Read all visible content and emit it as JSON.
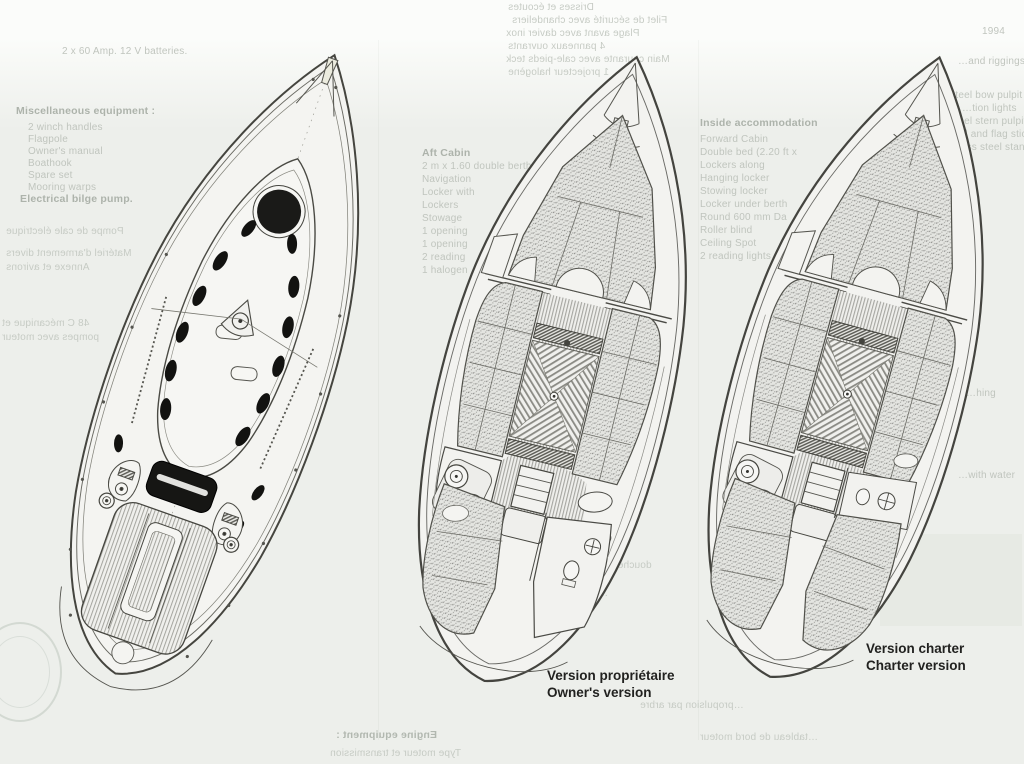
{
  "page": {
    "description": "Scanned sailboat brochure page with deck plan and two interior layout drawings",
    "colors": {
      "paper": "#edefeb",
      "ink": "#45453f",
      "caption_ink": "#222220",
      "ghost_text": "#c0c5be"
    }
  },
  "captions": {
    "owner": {
      "line1": "Version propriétaire",
      "line2": "Owner's version"
    },
    "charter": {
      "line1": "Version charter",
      "line2": "Charter version"
    }
  },
  "drawings": [
    {
      "id": "deck-plan",
      "description": "Deck plan seen from above: foredeck hatch, coachroof with portlights, mast, sprayhood, slatted cockpit benches"
    },
    {
      "id": "owner-layout",
      "description": "Interior plan, owner's version: V-berth, saloon with folding table, galley, nav/head, single aft cabin"
    },
    {
      "id": "charter-layout",
      "description": "Interior plan, charter version: V-berth, saloon with folding table, galley, head, twin aft cabins"
    }
  ],
  "ghost_text": {
    "note": "faint show-through / overexposed spec text from the printed page",
    "items": [
      {
        "x": 62,
        "y": 46,
        "t": "2 x 60 Amp. 12 V batteries.",
        "cls": ""
      },
      {
        "x": 16,
        "y": 106,
        "t": "Miscellaneous equipment :",
        "cls": "s"
      },
      {
        "x": 28,
        "y": 122,
        "t": "2 winch handles",
        "cls": ""
      },
      {
        "x": 28,
        "y": 134,
        "t": "Flagpole",
        "cls": ""
      },
      {
        "x": 28,
        "y": 146,
        "t": "Owner's manual",
        "cls": ""
      },
      {
        "x": 28,
        "y": 158,
        "t": "Boathook",
        "cls": ""
      },
      {
        "x": 28,
        "y": 170,
        "t": "Spare set",
        "cls": ""
      },
      {
        "x": 28,
        "y": 182,
        "t": "Mooring warps",
        "cls": ""
      },
      {
        "x": 20,
        "y": 194,
        "t": "Electrical bilge pump.",
        "cls": "s"
      },
      {
        "x": 6,
        "y": 226,
        "t": "Pompe de cale électrique",
        "cls": "m"
      },
      {
        "x": 6,
        "y": 248,
        "t": "Matériel d'armement divers",
        "cls": "m"
      },
      {
        "x": 6,
        "y": 262,
        "t": "Annexe et avirons",
        "cls": "m"
      },
      {
        "x": 2,
        "y": 318,
        "t": "48 C mécanique et",
        "cls": "m"
      },
      {
        "x": 2,
        "y": 332,
        "t": "pompes avec moteur",
        "cls": "m"
      },
      {
        "x": 508,
        "y": 2,
        "t": "Drisses et écoutes",
        "cls": "m"
      },
      {
        "x": 512,
        "y": 15,
        "t": "Filet de sécurité avec chandeliers",
        "cls": "m"
      },
      {
        "x": 506,
        "y": 28,
        "t": "Plage avant avec davier inox",
        "cls": "m"
      },
      {
        "x": 508,
        "y": 41,
        "t": "4 panneaux ouvrants",
        "cls": "m"
      },
      {
        "x": 506,
        "y": 54,
        "t": "Main courante avec cale-pieds teck",
        "cls": "m"
      },
      {
        "x": 508,
        "y": 67,
        "t": "1 projecteur halogène",
        "cls": "m"
      },
      {
        "x": 422,
        "y": 148,
        "t": "Aft Cabin",
        "cls": "s"
      },
      {
        "x": 422,
        "y": 161,
        "t": "2 m x 1.60 double berth",
        "cls": ""
      },
      {
        "x": 422,
        "y": 174,
        "t": "Navigation",
        "cls": ""
      },
      {
        "x": 422,
        "y": 187,
        "t": "Locker with",
        "cls": ""
      },
      {
        "x": 422,
        "y": 200,
        "t": "Lockers",
        "cls": ""
      },
      {
        "x": 422,
        "y": 213,
        "t": "Stowage",
        "cls": ""
      },
      {
        "x": 422,
        "y": 226,
        "t": "1 opening",
        "cls": ""
      },
      {
        "x": 422,
        "y": 239,
        "t": "1 opening",
        "cls": ""
      },
      {
        "x": 422,
        "y": 252,
        "t": "2 reading",
        "cls": ""
      },
      {
        "x": 422,
        "y": 265,
        "t": "1 halogen",
        "cls": ""
      },
      {
        "x": 700,
        "y": 118,
        "t": "Inside accommodation",
        "cls": "s"
      },
      {
        "x": 700,
        "y": 134,
        "t": "Forward Cabin",
        "cls": ""
      },
      {
        "x": 700,
        "y": 147,
        "t": "Double bed (2.20 ft x",
        "cls": ""
      },
      {
        "x": 700,
        "y": 160,
        "t": "Lockers along",
        "cls": ""
      },
      {
        "x": 700,
        "y": 173,
        "t": "Hanging locker",
        "cls": ""
      },
      {
        "x": 700,
        "y": 186,
        "t": "Stowing locker",
        "cls": ""
      },
      {
        "x": 700,
        "y": 199,
        "t": "Locker under berth",
        "cls": ""
      },
      {
        "x": 700,
        "y": 212,
        "t": "Round 600 mm Da",
        "cls": ""
      },
      {
        "x": 700,
        "y": 225,
        "t": "Roller blind",
        "cls": ""
      },
      {
        "x": 700,
        "y": 238,
        "t": "Ceiling Spot",
        "cls": ""
      },
      {
        "x": 700,
        "y": 251,
        "t": "2 reading lights",
        "cls": ""
      },
      {
        "x": 982,
        "y": 26,
        "t": "1994",
        "cls": ""
      },
      {
        "x": 958,
        "y": 56,
        "t": "…and riggings",
        "cls": ""
      },
      {
        "x": 940,
        "y": 90,
        "t": "…steel bow pulpit with integr",
        "cls": ""
      },
      {
        "x": 962,
        "y": 103,
        "t": "…tion lights",
        "cls": ""
      },
      {
        "x": 940,
        "y": 116,
        "t": "…steel stern pulpit with",
        "cls": ""
      },
      {
        "x": 946,
        "y": 129,
        "t": "…ed and flag stick",
        "cls": ""
      },
      {
        "x": 940,
        "y": 142,
        "t": "…inless steel stanchions",
        "cls": ""
      },
      {
        "x": 470,
        "y": 490,
        "t": "1 penderie, équipets et coffres",
        "cls": "m"
      },
      {
        "x": 468,
        "y": 520,
        "t": "2 équipiers",
        "cls": "m"
      },
      {
        "x": 470,
        "y": 545,
        "t": "Salle d'eau",
        "cls": "m"
      },
      {
        "x": 462,
        "y": 560,
        "t": "douche avec caillebotis et porte-serviette",
        "cls": "m"
      },
      {
        "x": 470,
        "y": 588,
        "t": "…couchette avec rangements",
        "cls": "m"
      },
      {
        "x": 966,
        "y": 388,
        "t": "…hing",
        "cls": ""
      },
      {
        "x": 958,
        "y": 470,
        "t": "…with water",
        "cls": ""
      },
      {
        "x": 336,
        "y": 730,
        "t": "Engine equipment :",
        "cls": "s m"
      },
      {
        "x": 330,
        "y": 748,
        "t": "Type moteur et transmission",
        "cls": "m"
      },
      {
        "x": 640,
        "y": 700,
        "t": "…propulsion par arbre",
        "cls": "m"
      },
      {
        "x": 700,
        "y": 732,
        "t": "…tableau de bord moteur",
        "cls": "m"
      }
    ]
  }
}
